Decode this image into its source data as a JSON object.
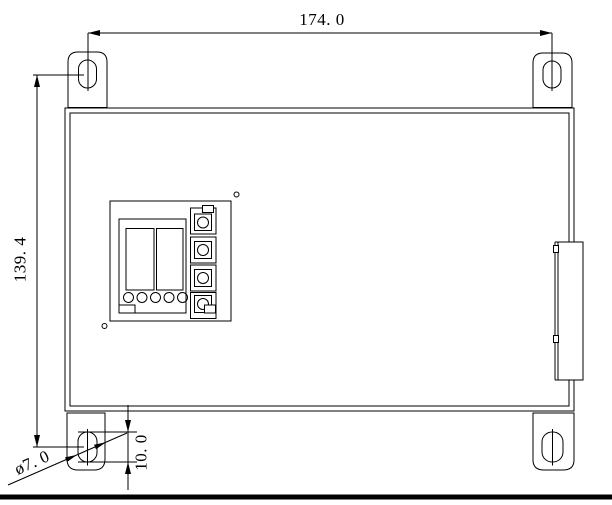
{
  "drawing": {
    "name": "control-box-front-view-technical-drawing",
    "background": "#ffffff",
    "line_color": "#000000",
    "labels": {
      "width": "174. 0",
      "height": "139. 4",
      "slot_length": "10. 0",
      "hole_diameter": "ø7. 0"
    }
  }
}
